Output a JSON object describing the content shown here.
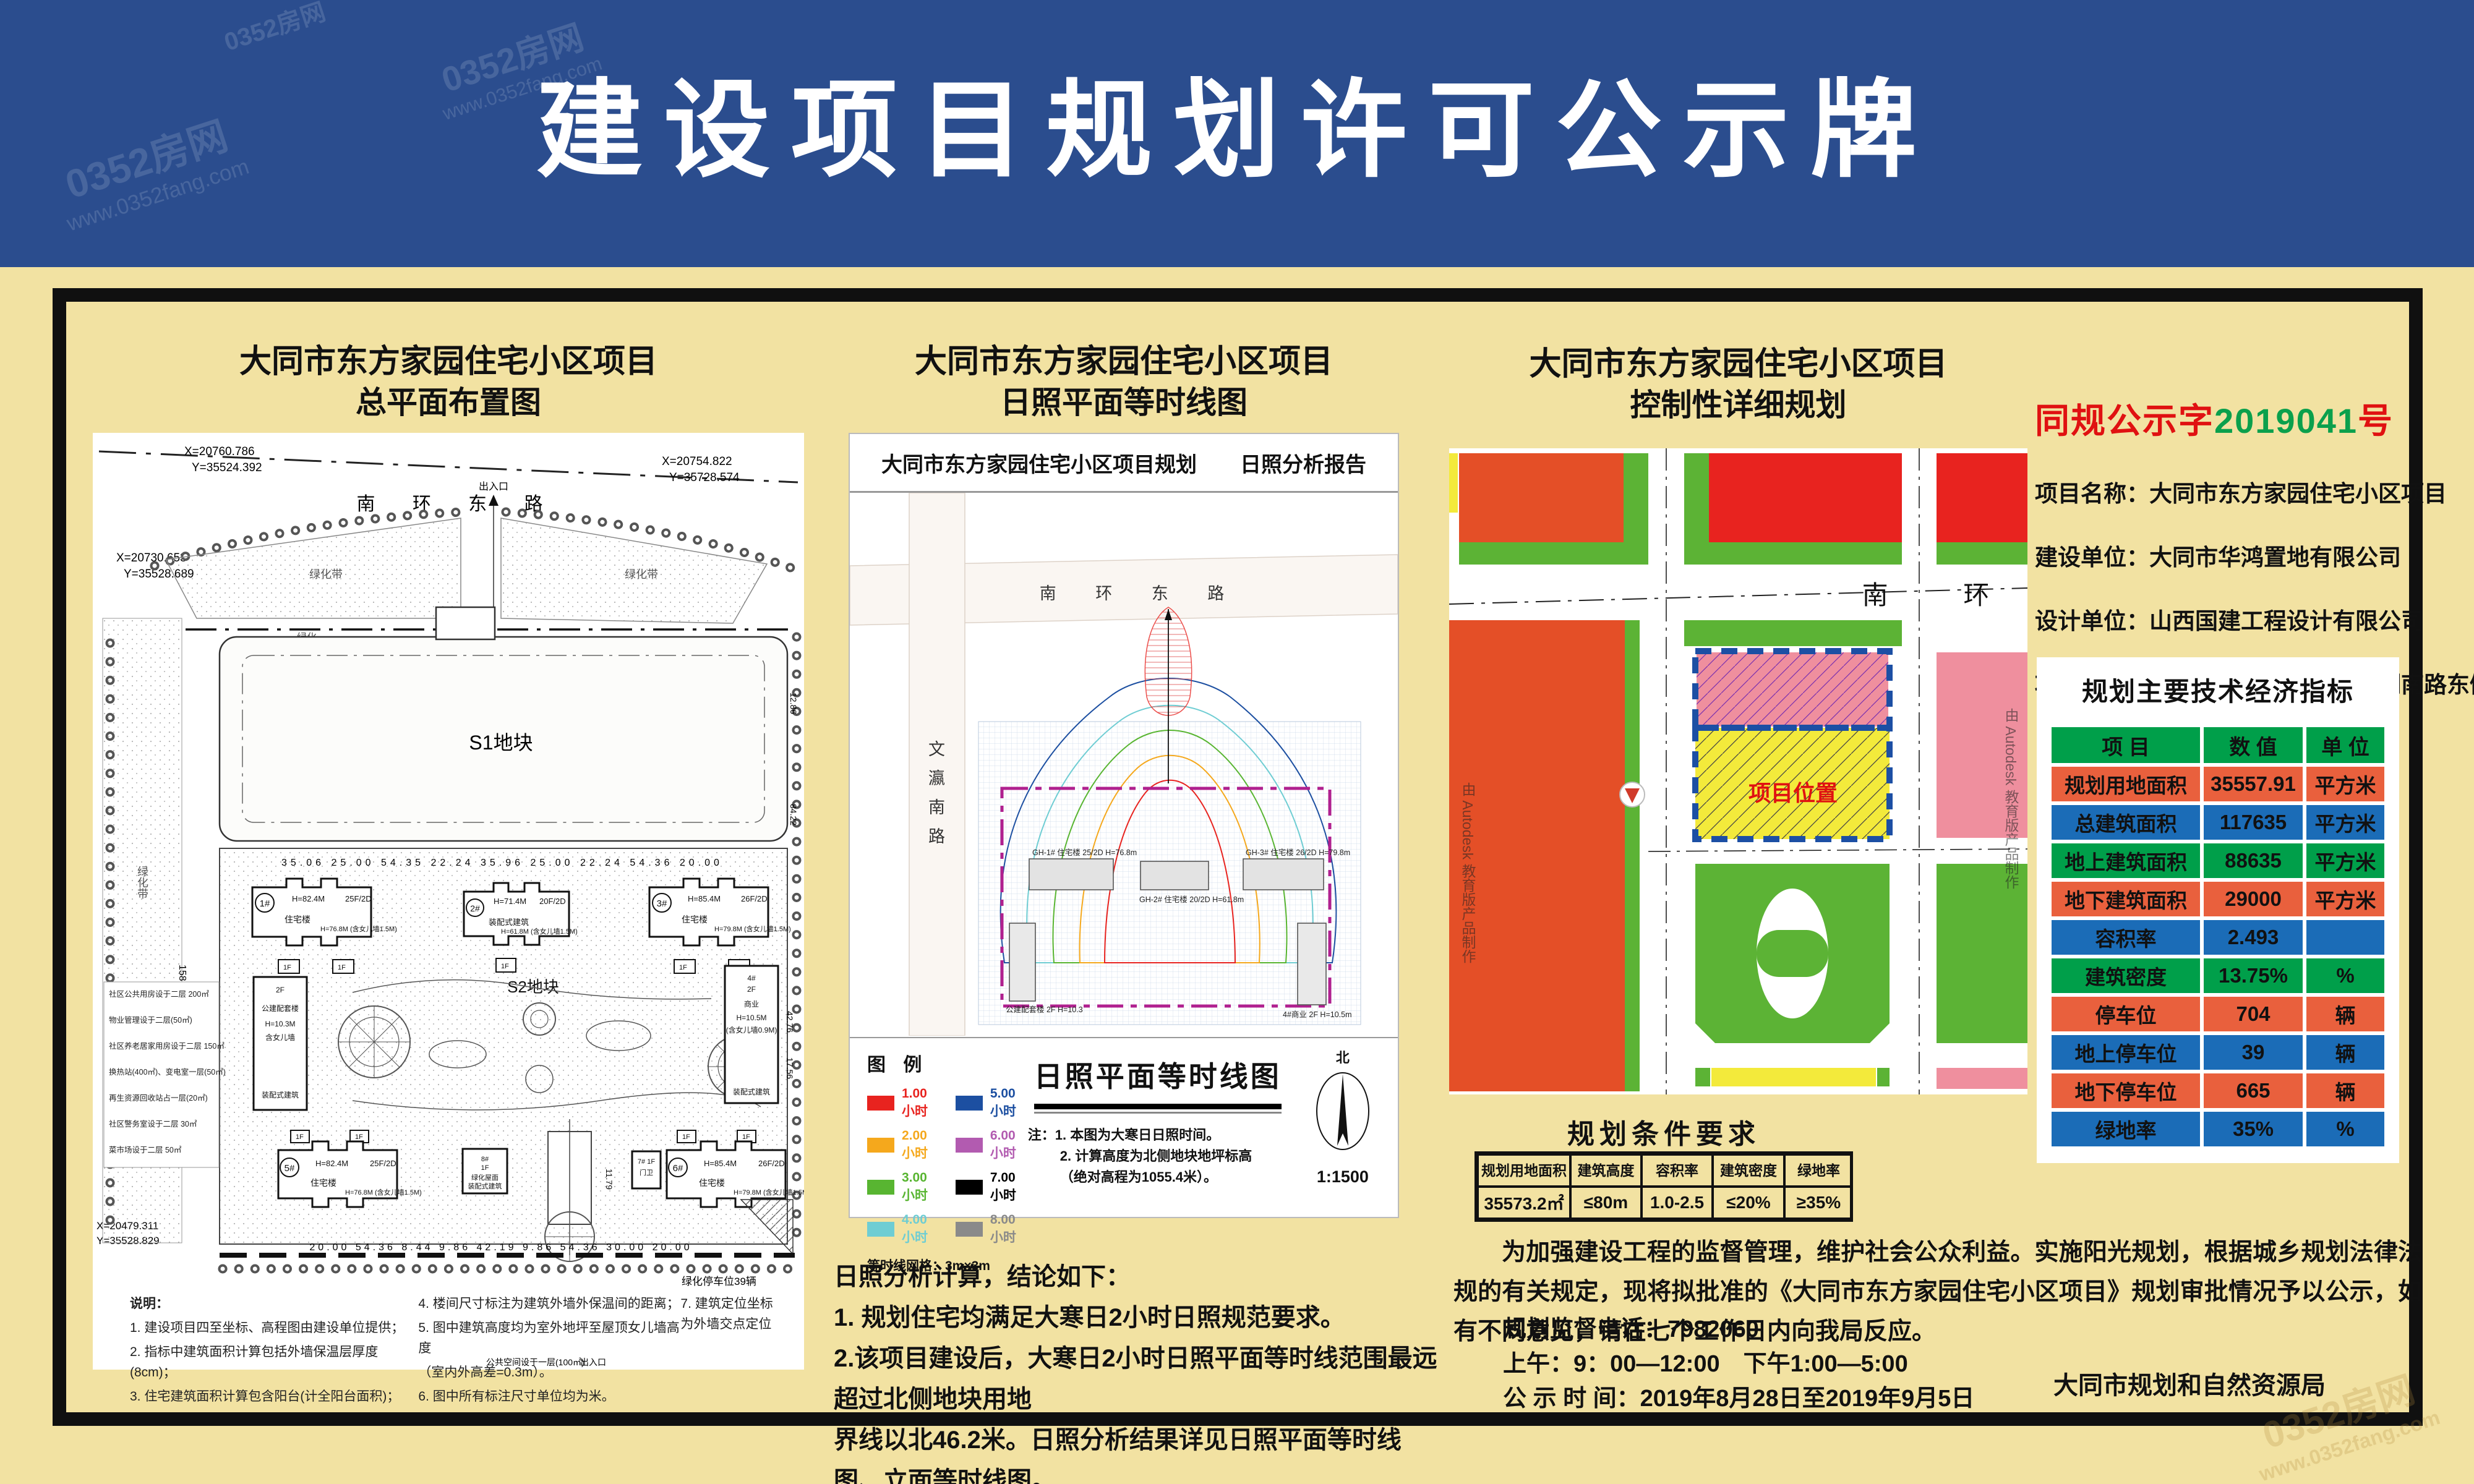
{
  "page": {
    "title": "建设项目规划许可公示牌"
  },
  "watermark": {
    "site": "0352房网",
    "url": "www.0352fang.com"
  },
  "left": {
    "title1": "大同市东方家园住宅小区项目",
    "title2": "总平面布置图",
    "road": "南    环    东    路",
    "entrance": "出入口",
    "coord_tl1": "X=20760.786",
    "coord_tl2": "Y=35524.392",
    "coord_tr1": "X=20754.822",
    "coord_tr2": "Y=35728.574",
    "coord_l1": "X=20730.653",
    "coord_l2": "Y=35528.689",
    "coord_bl1": "X=20479.311",
    "coord_bl2": "Y=35528.829",
    "green_belt": "绿化带",
    "green": "绿化",
    "s1": "S1地块",
    "s2": "S2地块",
    "b1": "1#",
    "b1h": "H=82.4M",
    "b1f": "25F/2D",
    "b1t": "住宅楼",
    "b1h2": "H=76.8M (含女儿墙1.5M)",
    "b2": "2#",
    "b2h": "H=71.4M",
    "b2f": "20F/2D",
    "b2t": "装配式建筑",
    "b2h2": "H=61.8M (含女儿墙1.5M)",
    "b3": "3#",
    "b3h": "H=85.4M",
    "b3f": "26F/2D",
    "b3t": "住宅楼",
    "b3h2": "H=79.8M (含女儿墙1.5M)",
    "b5": "5#",
    "b5h": "H=82.4M",
    "b5f": "25F/2D",
    "b5t": "住宅楼",
    "b5h2": "H=76.8M (含女儿墙1.5M)",
    "b6": "6#",
    "b6h": "H=85.4M",
    "b6f": "26F/2D",
    "b6t": "住宅楼",
    "b6h2": "H=79.8M (含女儿墙1.5M)",
    "b7": "7#",
    "b7t": "门卫",
    "b7f": "1F",
    "b8": "8#",
    "b8f": "1F",
    "b8t1": "绿化屋面",
    "b8t2": "装配式建筑",
    "b4": "4#",
    "b4f": "2F",
    "b4t": "商业",
    "b4h": "H=10.5M",
    "b4h2": "(含女儿墙0.9M)",
    "b4t2": "装配式建筑",
    "pub1": "2F",
    "pub2": "公建配套楼",
    "pub3": "H=10.3M",
    "pub4": "含女儿墙",
    "pub5": "装配式建筑",
    "onef": "1F",
    "green_parking": "绿化停车位39辆",
    "public_space": "公共空间设于一层(100㎡)",
    "dims_row1": "35.06   25.00   54.35   22.24   35.96   25.00   22.24   54.36   20.00",
    "dims_row2": "20.00   54.36   8.44   9.86   42.19   9.86   54.36   30.00   20.00",
    "dim_left": "158.86",
    "dim_r1": "42.76",
    "dim_r2": "17.56",
    "dim_r3": "84.22",
    "dim_r4": "12.86",
    "dim_c2": "11.79",
    "side_notes": [
      "社区公共用房设于二层 200㎡",
      "物业管理设于二层(50㎡)",
      "社区养老居家用房设于二层 150㎡",
      "换热站(400㎡)、变电室一层(50㎡)",
      "再生资源回收站占一层(20㎡)",
      "社区警务室设于二层 30㎡",
      "菜市场设于二层 50㎡"
    ],
    "notes_title": "说明：",
    "notes_col1": [
      "1.  建设项目四至坐标、高程图由建设单位提供；",
      "2.  指标中建筑面积计算包括外墙保温层厚度(8cm)；",
      "3.  住宅建筑面积计算包含阳台(计全阳台面积)；"
    ],
    "notes_col2": [
      "4.  楼间尺寸标注为建筑外墙外保温间的距离；",
      "5.  图中建筑高度均为室外地坪至屋顶女儿墙高度",
      "（室内外高差=0.3m）。",
      "6.  图中所有标注尺寸单位均为米。"
    ],
    "notes_col3": [
      "7. 建筑定位坐标为外墙交点定位"
    ]
  },
  "mid": {
    "title1": "大同市东方家园住宅小区项目",
    "title2": "日照平面等时线图",
    "report1": "大同市东方家园住宅小区项目规划",
    "report2": "日照分析报告",
    "road_h": "南    环    东    路",
    "road_v": "文瀛南路",
    "legend_title": "图  例",
    "legend": [
      {
        "label": "1.00 小时",
        "color": "#e8231f"
      },
      {
        "label": "2.00 小时",
        "color": "#f5a81c"
      },
      {
        "label": "3.00 小时",
        "color": "#58b531"
      },
      {
        "label": "4.00 小时",
        "color": "#6fcdd3"
      },
      {
        "label": "5.00 小时",
        "color": "#1c4fa1"
      },
      {
        "label": "6.00 小时",
        "color": "#b25bb0"
      },
      {
        "label": "7.00 小时",
        "color": "#000000"
      },
      {
        "label": "8.00 小时",
        "color": "#8a8a8a"
      }
    ],
    "grid_note": "等时线网格：3m×3m",
    "diagram_title": "日照平面等时线图",
    "note1": "注：1. 本图为大寒日日照时间。",
    "note2": "2. 计算高度为北侧地块地坪标高",
    "note3": "（绝对高程为1055.4米）。",
    "north": "北",
    "scale": "1:1500",
    "mb1": "GH-1# 住宅楼 25/2D H=76.8m",
    "mb2": "GH-2# 住宅楼 20/2D H=61.8m",
    "mb3": "GH-3# 住宅楼 26/2D H=79.8m",
    "mb4": "公建配套楼 2F H=10.3",
    "mb5": "4#商业 2F H=10.5m",
    "concl_title": "日照分析计算，结论如下：",
    "concl1": "1. 规划住宅均满足大寒日2小时日照规范要求。",
    "concl2": "2.该项目建设后，大寒日2小时日照平面等时线范围最远超过北侧地块用地",
    "concl3": "界线以北46.2米。日照分析结果详见日照平面等时线图、立面等时线图。"
  },
  "right": {
    "title1": "大同市东方家园住宅小区项目",
    "title2": "控制性详细规划",
    "road": "南    环",
    "location": "项目位置",
    "autodesk": "由 Autodesk 教育版产品制作",
    "cond_title": "规划条件要求",
    "cond_headers": [
      "规划用地面积",
      "建筑高度",
      "容积率",
      "建筑密度",
      "绿地率"
    ],
    "cond_values": [
      "35573.2㎡",
      "≤80m",
      "1.0-2.5",
      "≤20%",
      "≥35%"
    ],
    "para": "为加强建设工程的监督管理，维护社会公众利益。实施阳光规划，根据城乡规划法律法规的有关规定，现将拟批准的《大同市东方家园住宅小区项目》规划审批情况予以公示，如有不同意见，请在七个工作日内向我局反应。",
    "phone": "规划监督电话：7982060",
    "hours": "上午：9：00—12:00　下午1:00—5:00",
    "period": "公 示 时 间：2019年8月28日至2019年9月5日",
    "agency": "大同市规划和自然资源局"
  },
  "info": {
    "permit_prefix": "同规公示字",
    "permit_no": "2019041",
    "permit_suffix": "号",
    "rows": [
      {
        "label": "项目名称：",
        "value": "大同市东方家园住宅小区项目"
      },
      {
        "label": "建设单位：",
        "value": "大同市华鸿置地有限公司"
      },
      {
        "label": "设计单位：",
        "value": "山西国建工程设计有限公司"
      },
      {
        "label": "项目位置：",
        "value": "大同南环路南侧、文瀛湖南路东侧"
      }
    ],
    "table_title": "规划主要技术经济指标",
    "headers": [
      "项  目",
      "数  值",
      "单  位"
    ],
    "indicators": [
      {
        "item": "规划用地面积",
        "value": "35557.91",
        "unit": "平方米",
        "tone": "orange"
      },
      {
        "item": "总建筑面积",
        "value": "117635",
        "unit": "平方米",
        "tone": "blue"
      },
      {
        "item": "地上建筑面积",
        "value": "88635",
        "unit": "平方米",
        "tone": "green"
      },
      {
        "item": "地下建筑面积",
        "value": "29000",
        "unit": "平方米",
        "tone": "orange"
      },
      {
        "item": "容积率",
        "value": "2.493",
        "unit": "",
        "tone": "blue"
      },
      {
        "item": "建筑密度",
        "value": "13.75%",
        "unit": "%",
        "tone": "green"
      },
      {
        "item": "停车位",
        "value": "704",
        "unit": "辆",
        "tone": "orange"
      },
      {
        "item": "地上停车位",
        "value": "39",
        "unit": "辆",
        "tone": "blue"
      },
      {
        "item": "地下停车位",
        "value": "665",
        "unit": "辆",
        "tone": "orange"
      },
      {
        "item": "绿地率",
        "value": "35%",
        "unit": "%",
        "tone": "blue"
      }
    ],
    "colors": {
      "green": "#009f4a",
      "blue": "#1b6cb7",
      "orange": "#e9603d",
      "header_blue": "#2b4d8e",
      "bg_yellow": "#f2e2a2"
    }
  }
}
